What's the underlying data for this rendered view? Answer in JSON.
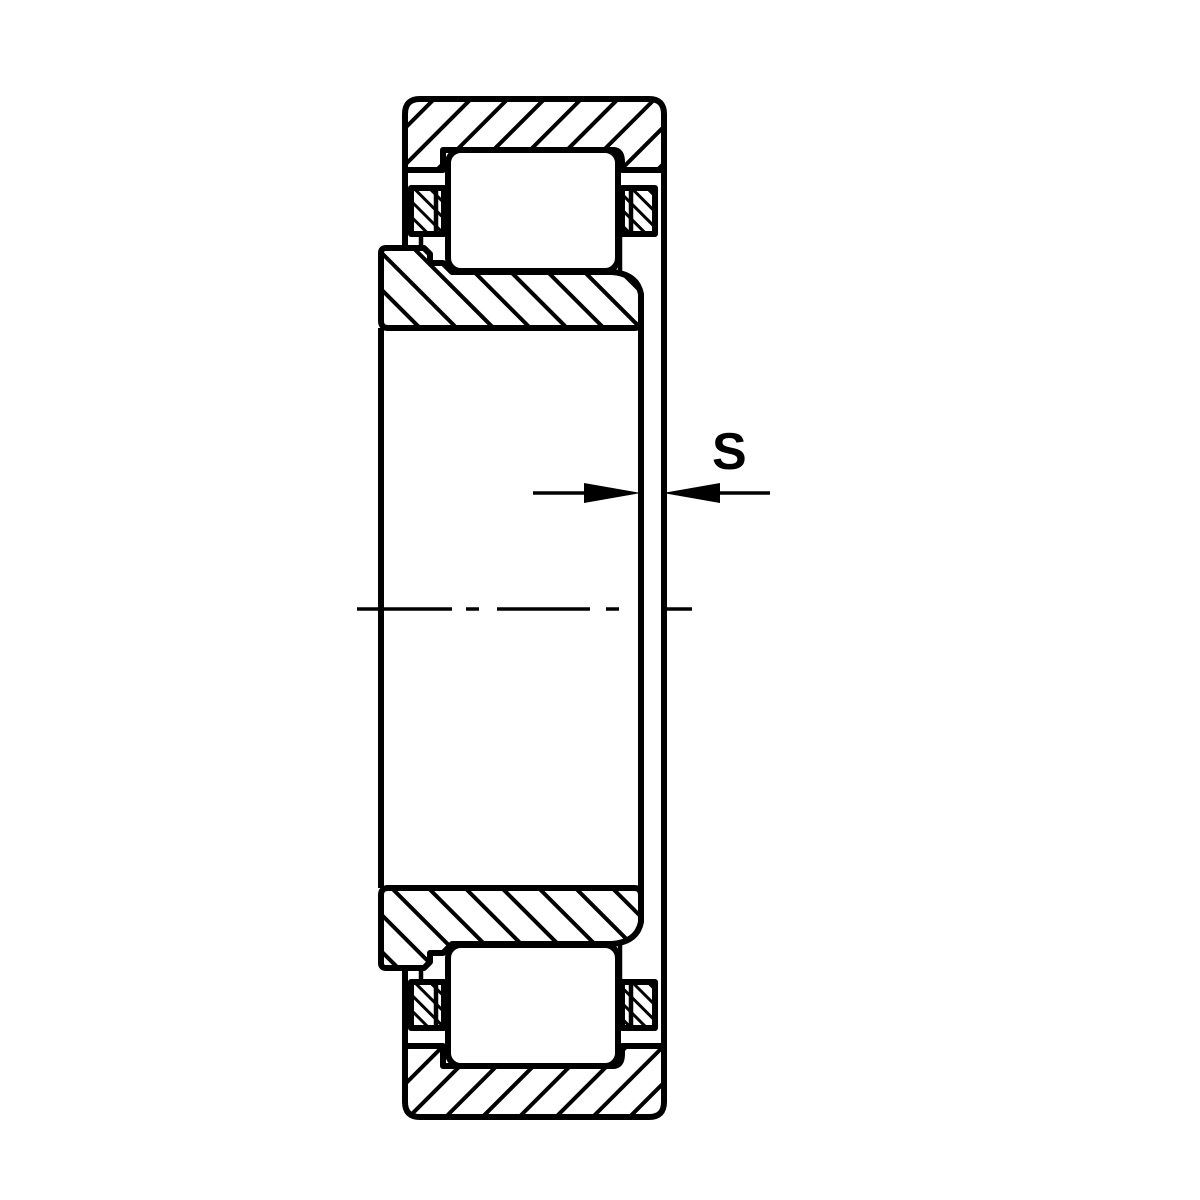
{
  "figure": {
    "dimension_label": "S",
    "colors": {
      "line": "#000000",
      "background": "#ffffff"
    },
    "parts": {
      "outer_ring": "outer-ring",
      "inner_ring": "inner-ring",
      "rolling_element": "cylindrical-roller",
      "cage": "cage",
      "axis": "centerline",
      "dimension": "axial-offset-dimension"
    }
  }
}
